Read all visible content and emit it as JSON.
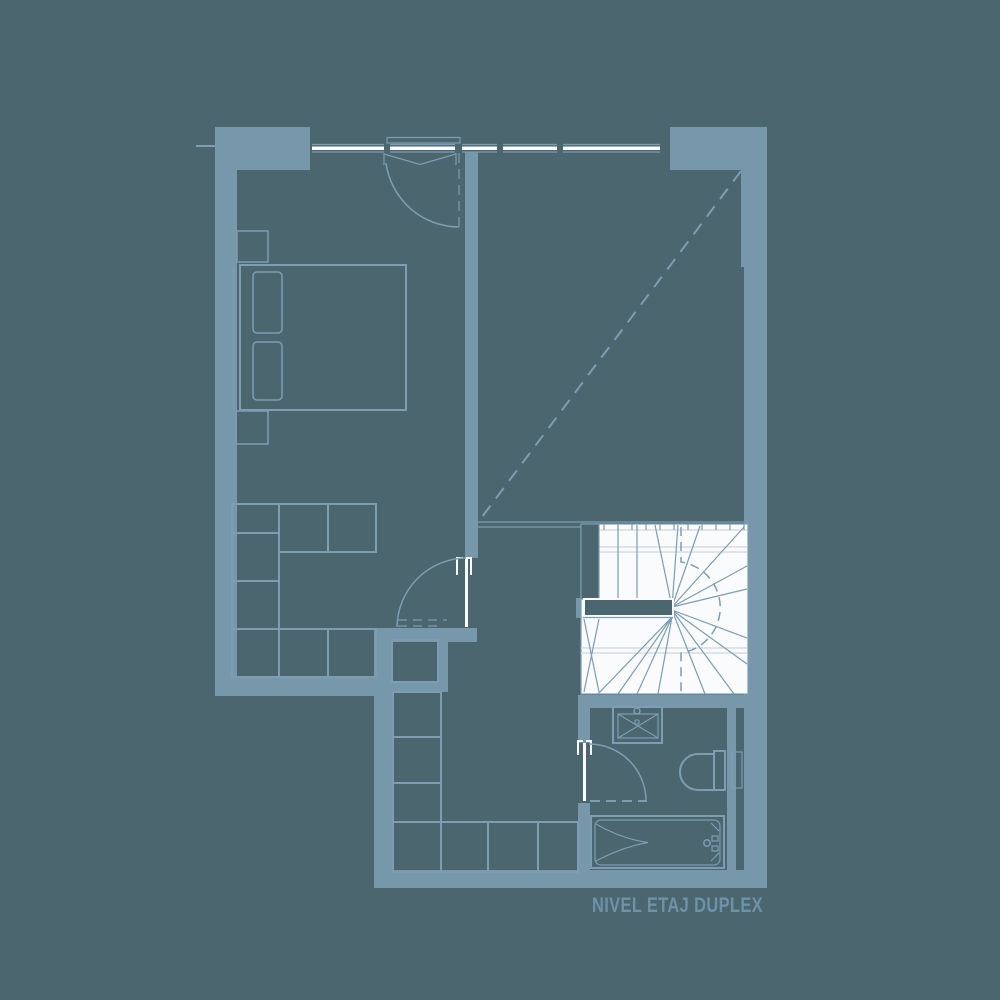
{
  "plan": {
    "label": "NIVEL ETAJ DUPLEX"
  },
  "colors": {
    "bg": "#4c6670",
    "wall": "#7797ab",
    "line": "#7d9db2",
    "paper": "#f9fbfc",
    "tread": "#d5dde2",
    "text": "#6e92a7"
  },
  "fixtures": {
    "bed": "double-bed-symbol",
    "wardrobe": "cabinet-grid-symbol",
    "stairs": "winder-stair-symbol",
    "sink": "washbasin-symbol",
    "toilet": "wc-symbol",
    "bathtub": "bathtub-symbol",
    "door": "swing-door-symbol",
    "window": "glazed-window-symbol",
    "void": "dashed-void-line"
  }
}
